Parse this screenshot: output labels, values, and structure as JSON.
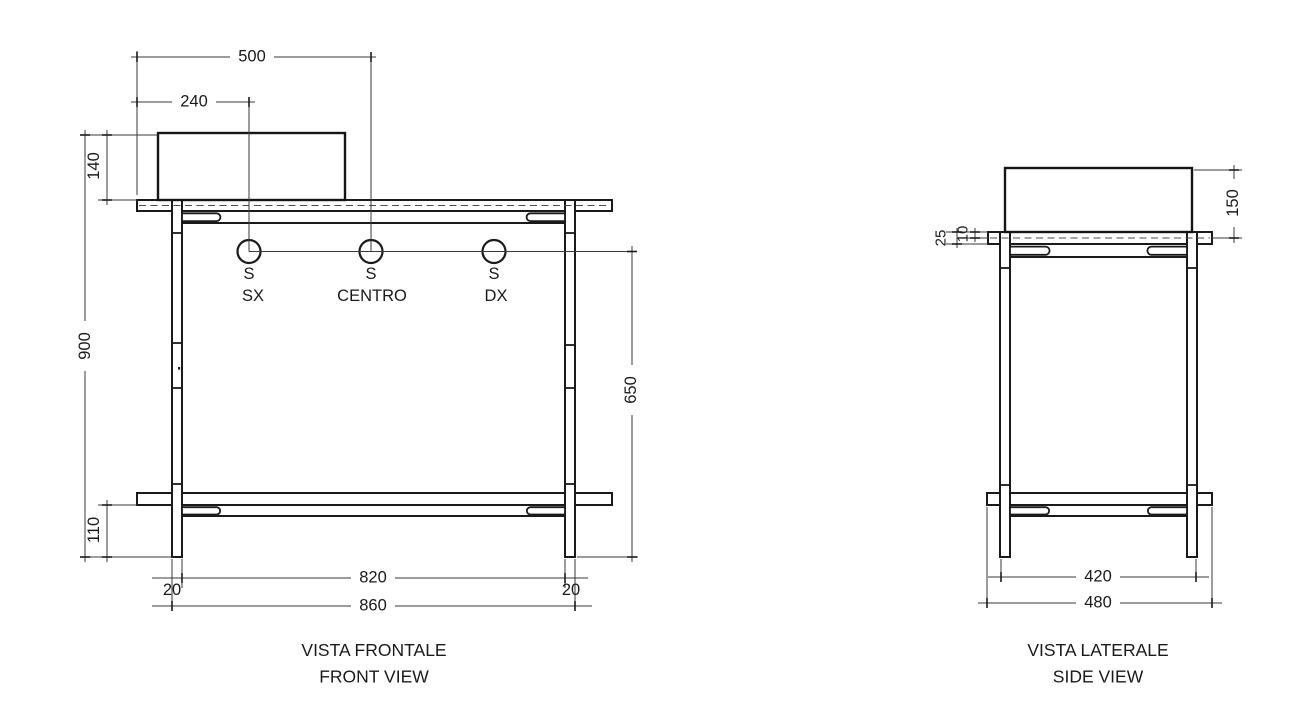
{
  "drawing": {
    "colors": {
      "background": "#ffffff",
      "line": "#1a1a1a"
    },
    "front_view": {
      "title_primary": "VISTA FRONTALE",
      "title_secondary": "FRONT VIEW",
      "taps": {
        "symbol": "S",
        "positions": [
          "SX",
          "CENTRO",
          "DX"
        ]
      },
      "dimensions": {
        "tap_centro_offset": "500",
        "tap_sx_offset": "240",
        "basin_height": "140",
        "overall_height": "900",
        "shelf_bottom_offset": "110",
        "tap_height_over_floor": "650",
        "left_leg_thickness": "20",
        "inner_leg_span": "820",
        "right_leg_thickness": "20",
        "overall_width": "860"
      }
    },
    "side_view": {
      "title_primary": "VISTA LATERALE",
      "title_secondary": "SIDE VIEW",
      "dimensions": {
        "basin_height": "150",
        "top_thickness_total": "25",
        "top_thickness_surface": "10",
        "leg_span": "420",
        "overall_depth": "480"
      }
    }
  }
}
